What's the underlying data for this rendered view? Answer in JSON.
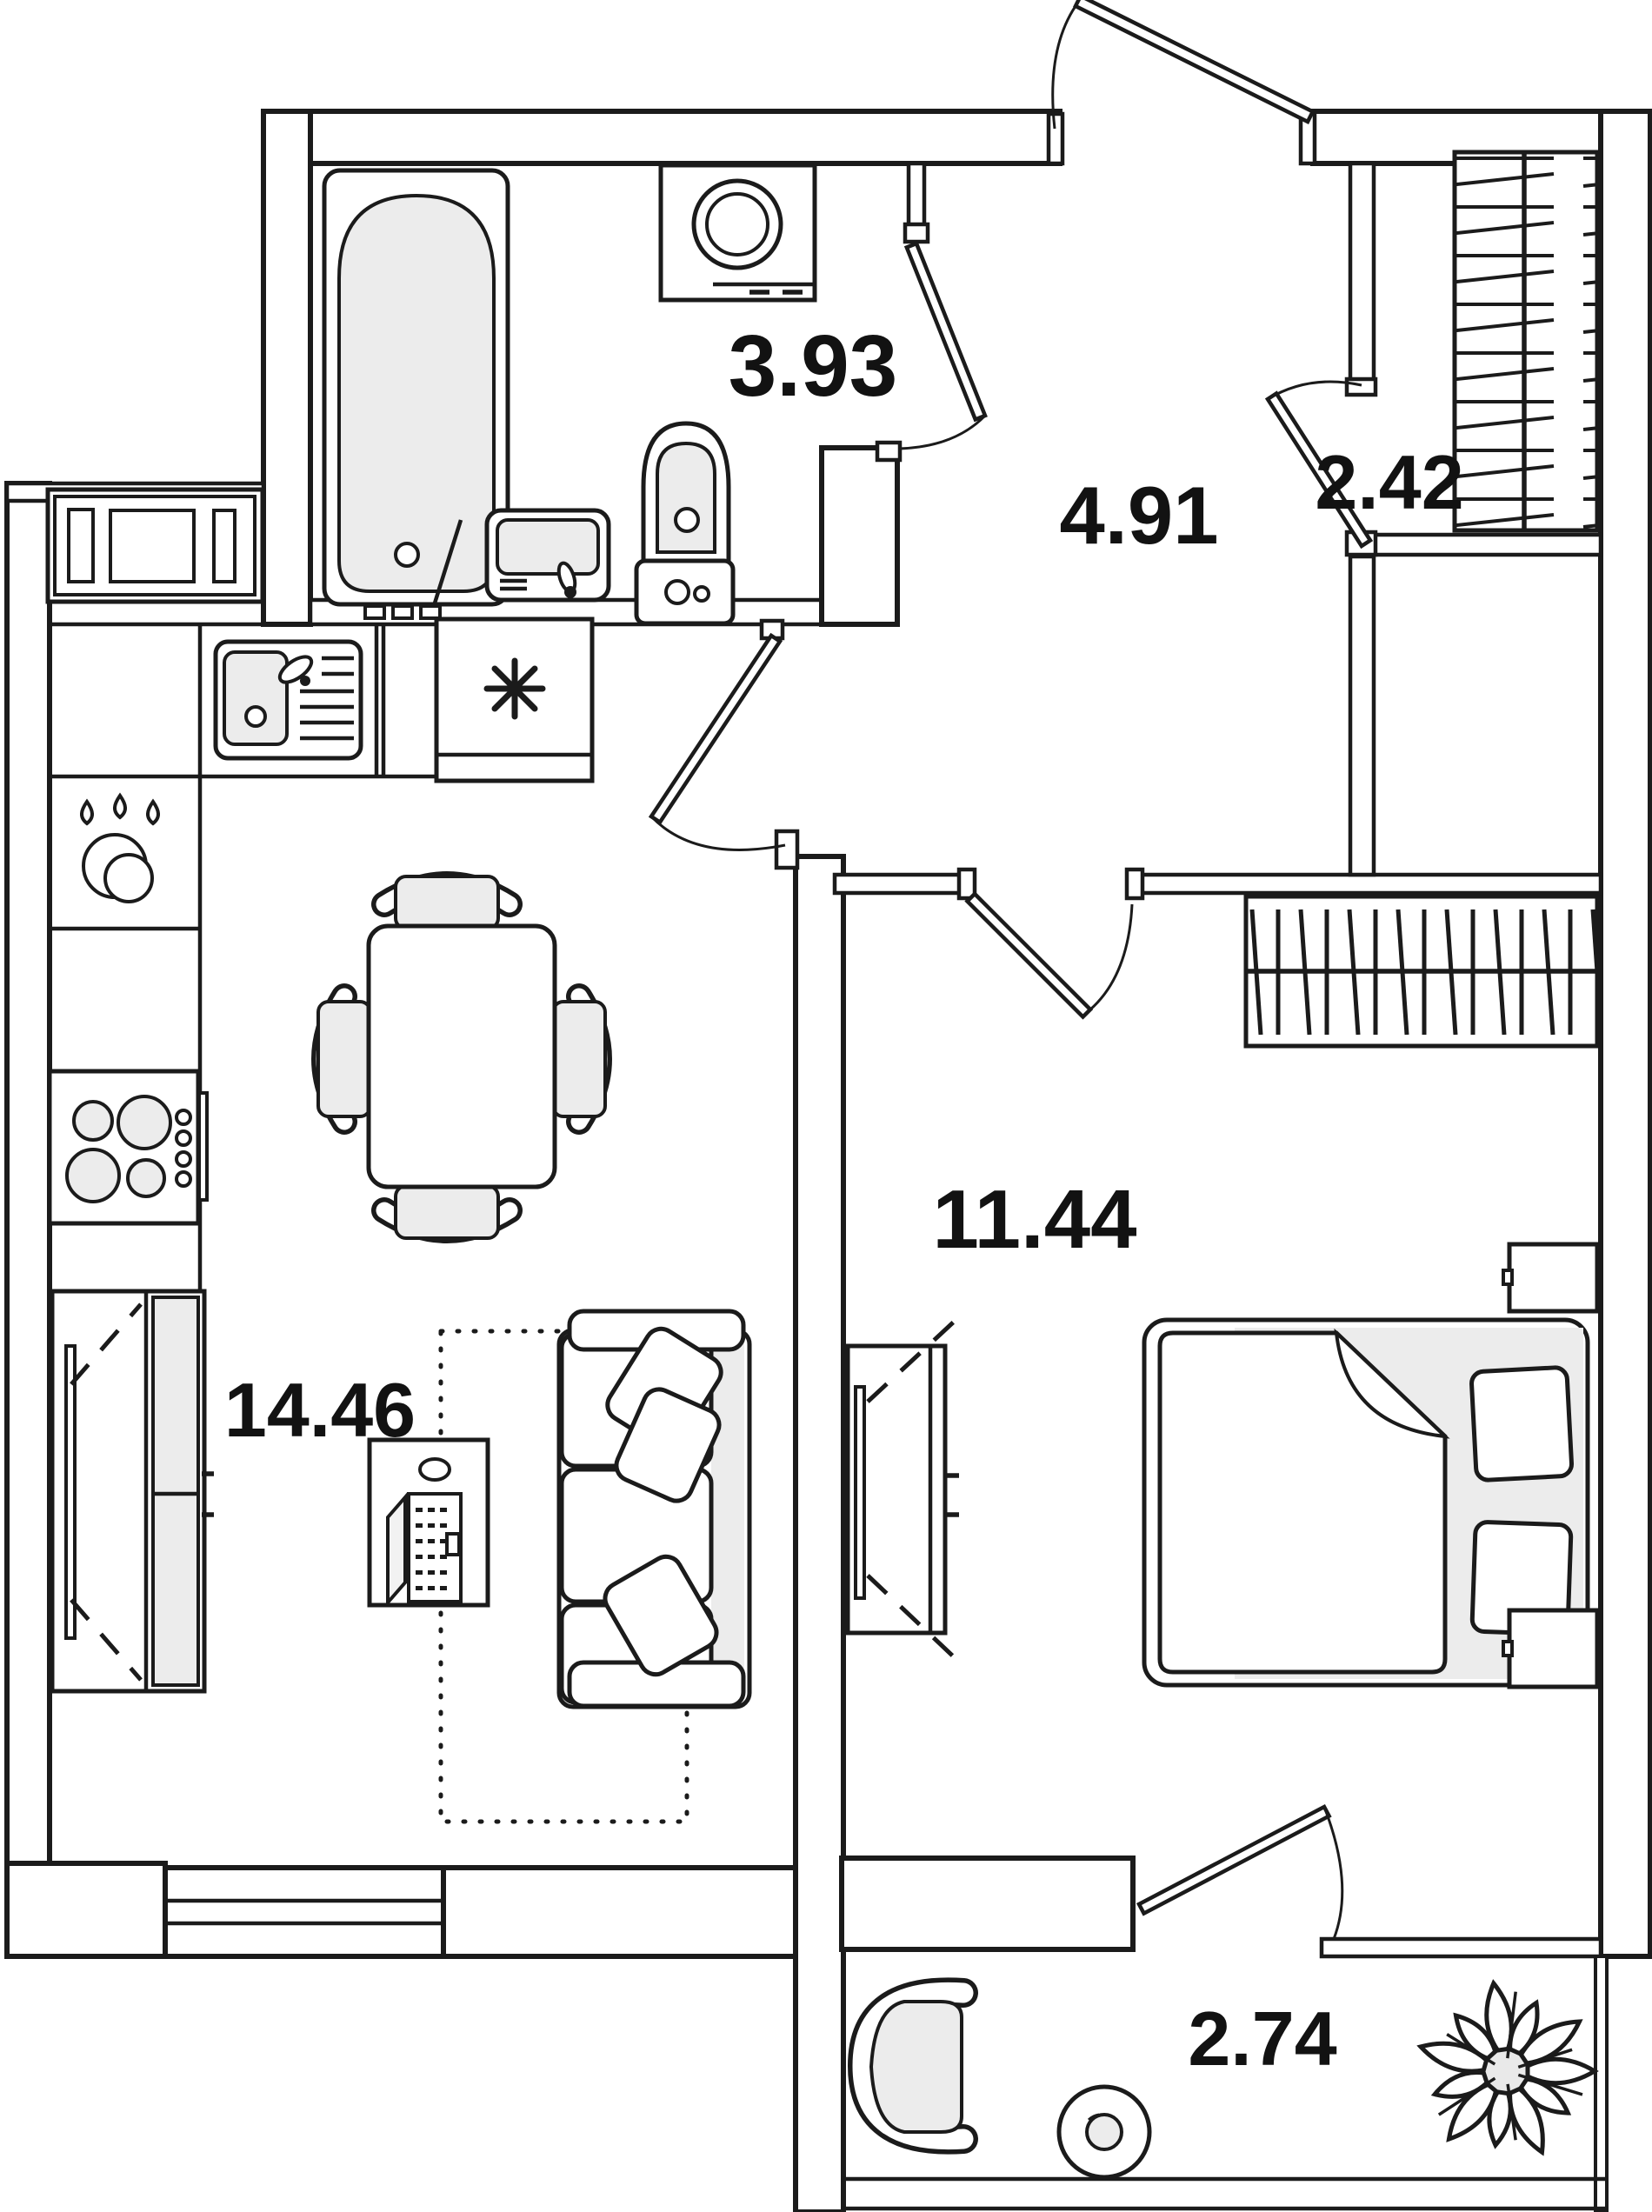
{
  "plan": {
    "title": "apartment-floor-plan",
    "colors": {
      "line": "#1b1b1b",
      "light_fill": "#ececec",
      "background": "#ffffff"
    },
    "rooms": [
      {
        "id": "bathroom",
        "name": "bathroom",
        "area": "3.93"
      },
      {
        "id": "hallway",
        "name": "hallway",
        "area": "4.91"
      },
      {
        "id": "closet",
        "name": "wardrobe-closet",
        "area": "2.42"
      },
      {
        "id": "bedroom",
        "name": "bedroom",
        "area": "11.44"
      },
      {
        "id": "kitchen_living",
        "name": "kitchen-living-room",
        "area": "14.46"
      },
      {
        "id": "balcony",
        "name": "balcony",
        "area": "2.74"
      }
    ],
    "fixtures": [
      "bathtub",
      "washing-machine",
      "bathroom-sink",
      "toilet",
      "microwave",
      "kitchen-sink",
      "fridge",
      "dishwasher",
      "stove",
      "dining-table",
      "chairs",
      "sofa",
      "desk",
      "laptop",
      "rug",
      "wardrobe-living",
      "tv-cabinet",
      "hall-wardrobe",
      "closet-wardrobe",
      "bed",
      "nightstands",
      "armchair",
      "balcony-table",
      "plant",
      "entrance-door",
      "interior-doors",
      "window"
    ]
  }
}
